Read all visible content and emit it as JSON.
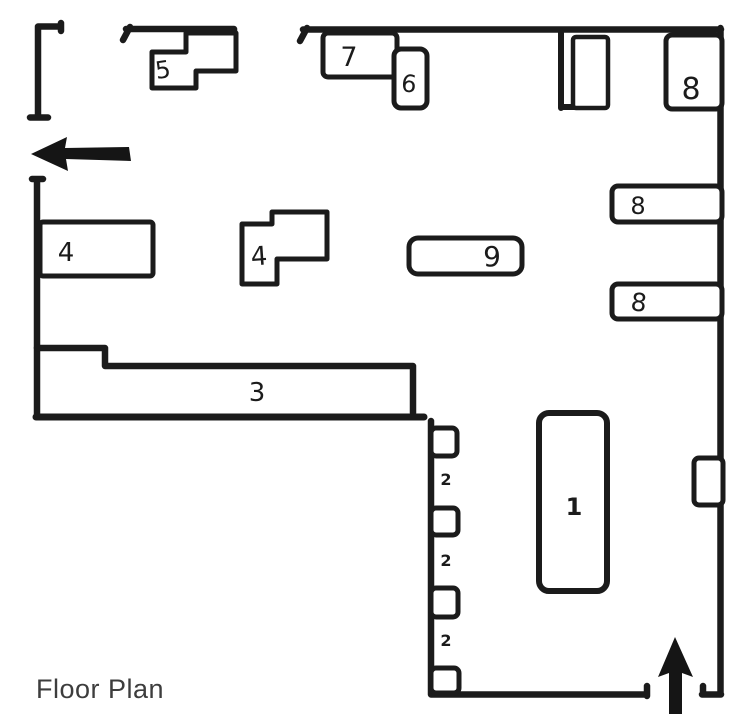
{
  "caption": "Floor Plan",
  "colors": {
    "ink": "#1b1b1b",
    "paper": "#ffffff",
    "caption_text": "#3d3d3d"
  },
  "rooms": {
    "r1": "1",
    "r2a": "2",
    "r2b": "2",
    "r2c": "2",
    "r3": "3",
    "r4a": "4",
    "r4b": "4",
    "r5": "5",
    "r6": "6",
    "r7": "7",
    "r8a": "8",
    "r8b": "8",
    "r8c": "8",
    "r9": "9"
  }
}
